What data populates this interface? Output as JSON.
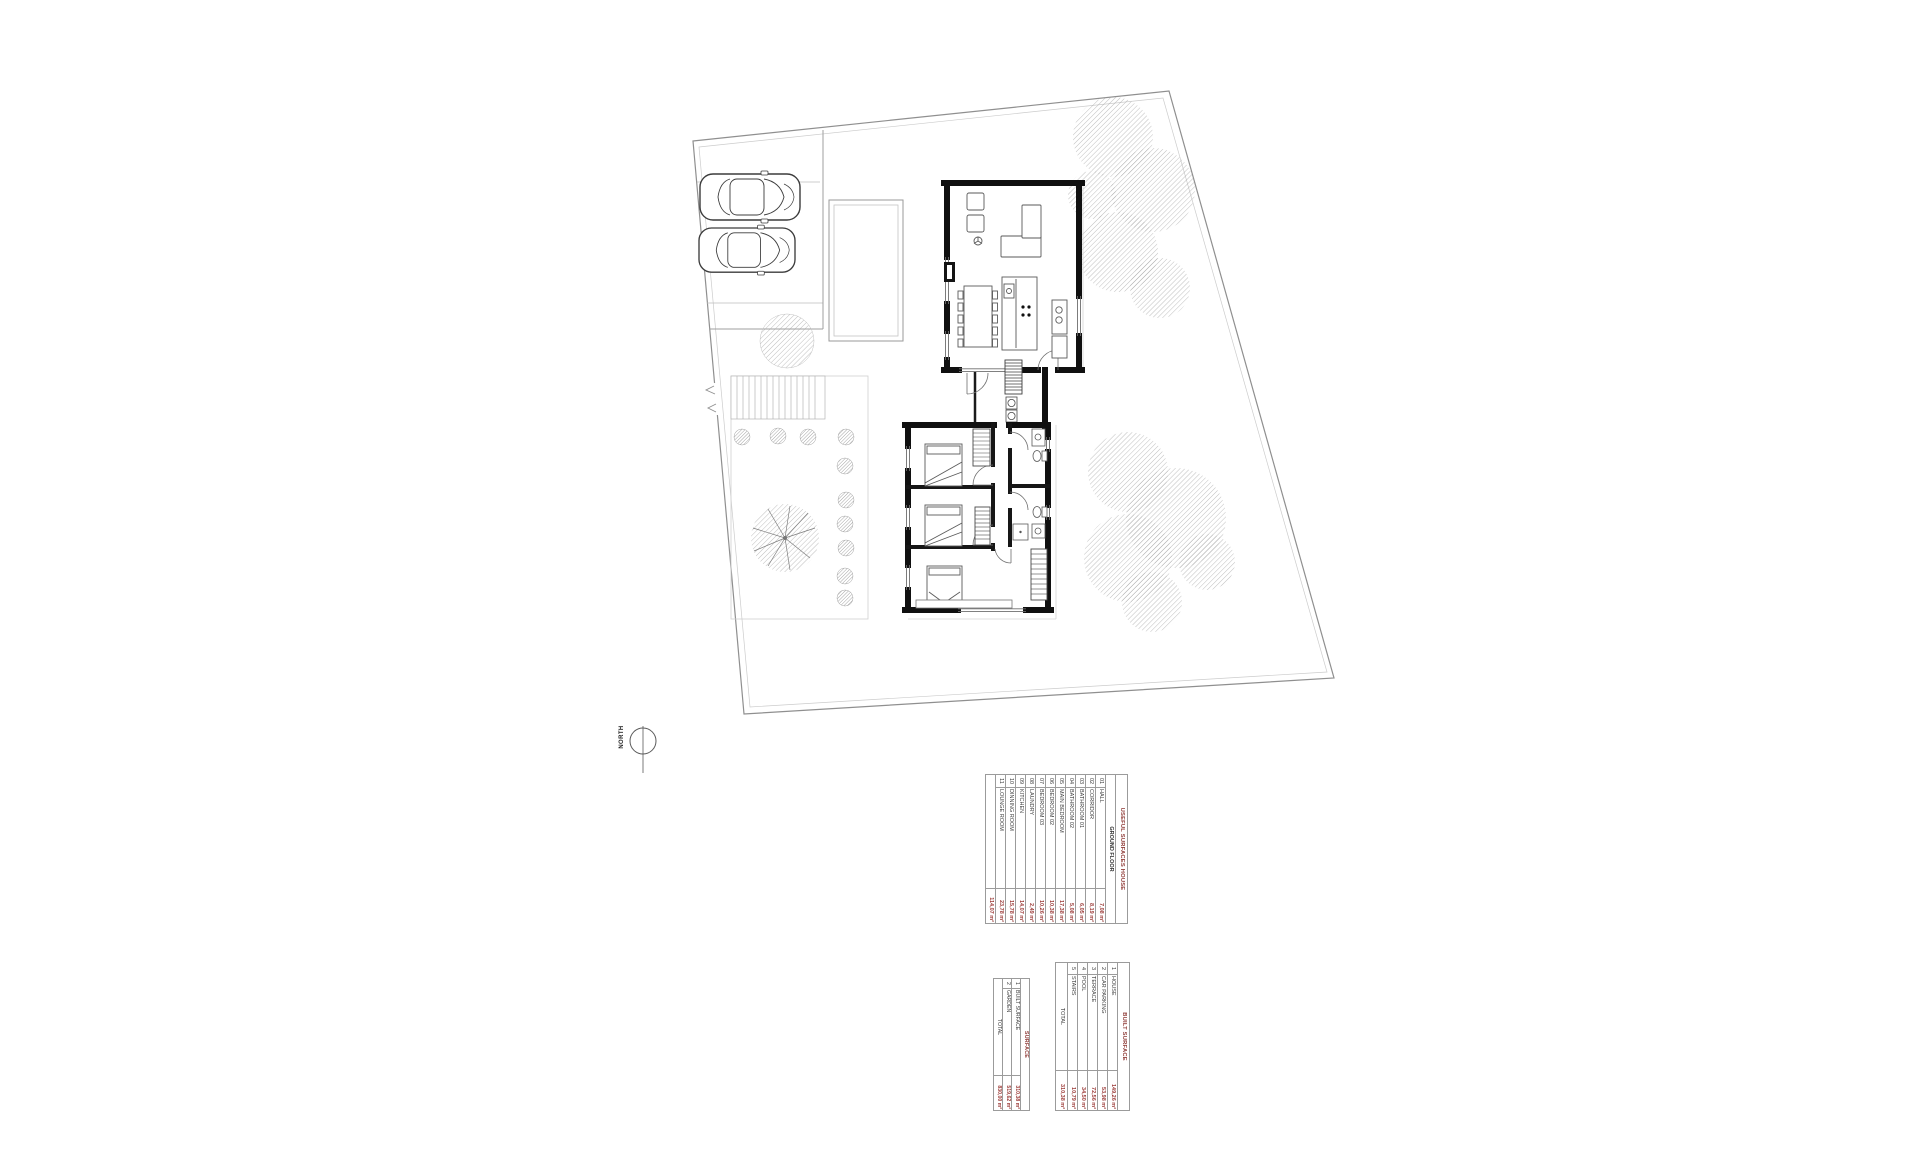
{
  "north_label": "NORTH",
  "colors": {
    "accent_red": "#9c3b38",
    "wall_black": "#101010",
    "line_grey": "#9b9b9b"
  },
  "tables": {
    "useful_surfaces": {
      "title": "USEFUL SURFACES HOUSE",
      "subtitle": "GROUND FLOOR",
      "rows": [
        {
          "num": "01",
          "name": "HALL",
          "value": "7,08 m²"
        },
        {
          "num": "02",
          "name": "CORRIDOR",
          "value": "8,19 m²"
        },
        {
          "num": "03",
          "name": "BATHROOM 01",
          "value": "6,05 m²"
        },
        {
          "num": "04",
          "name": "BATHROOM 02",
          "value": "5,08 m²"
        },
        {
          "num": "05",
          "name": "MAIN BEDROOM",
          "value": "17,38 m²"
        },
        {
          "num": "06",
          "name": "BEDROOM 02",
          "value": "10,38 m²"
        },
        {
          "num": "07",
          "name": "BEDROOM 03",
          "value": "10,26 m²"
        },
        {
          "num": "08",
          "name": "LAUNDRY",
          "value": "2,49 m²"
        },
        {
          "num": "09",
          "name": "KITCHEN",
          "value": "14,07 m²"
        },
        {
          "num": "10",
          "name": "DINNING ROOM",
          "value": "15,78 m²"
        },
        {
          "num": "11",
          "name": "LOUNGE ROOM",
          "value": "23,78 m²"
        }
      ],
      "total": {
        "label": "",
        "value": "114,07 m²"
      }
    },
    "built_surface": {
      "title": "BUILT SURFACE",
      "rows": [
        {
          "num": "1",
          "name": "HOUSE",
          "value": "149,26 m²"
        },
        {
          "num": "2",
          "name": "CAR PARKING",
          "value": "53,98 m²"
        },
        {
          "num": "3",
          "name": "TERRACE",
          "value": "72,56 m²"
        },
        {
          "num": "4",
          "name": "POOL",
          "value": "34,50 m²"
        },
        {
          "num": "5",
          "name": "STAIRS",
          "value": "10,79 m²"
        }
      ],
      "total": {
        "label": "TOTAL",
        "value": "310,38 m²"
      }
    },
    "surface": {
      "title": "SURFACE",
      "rows": [
        {
          "num": "1",
          "name": "BUILT SURFACE",
          "value": "310,38 m²"
        },
        {
          "num": "2",
          "name": "GARDEN",
          "value": "519,62 m²"
        }
      ],
      "total": {
        "label": "TOTAL",
        "value": "830,00 m²"
      }
    }
  }
}
